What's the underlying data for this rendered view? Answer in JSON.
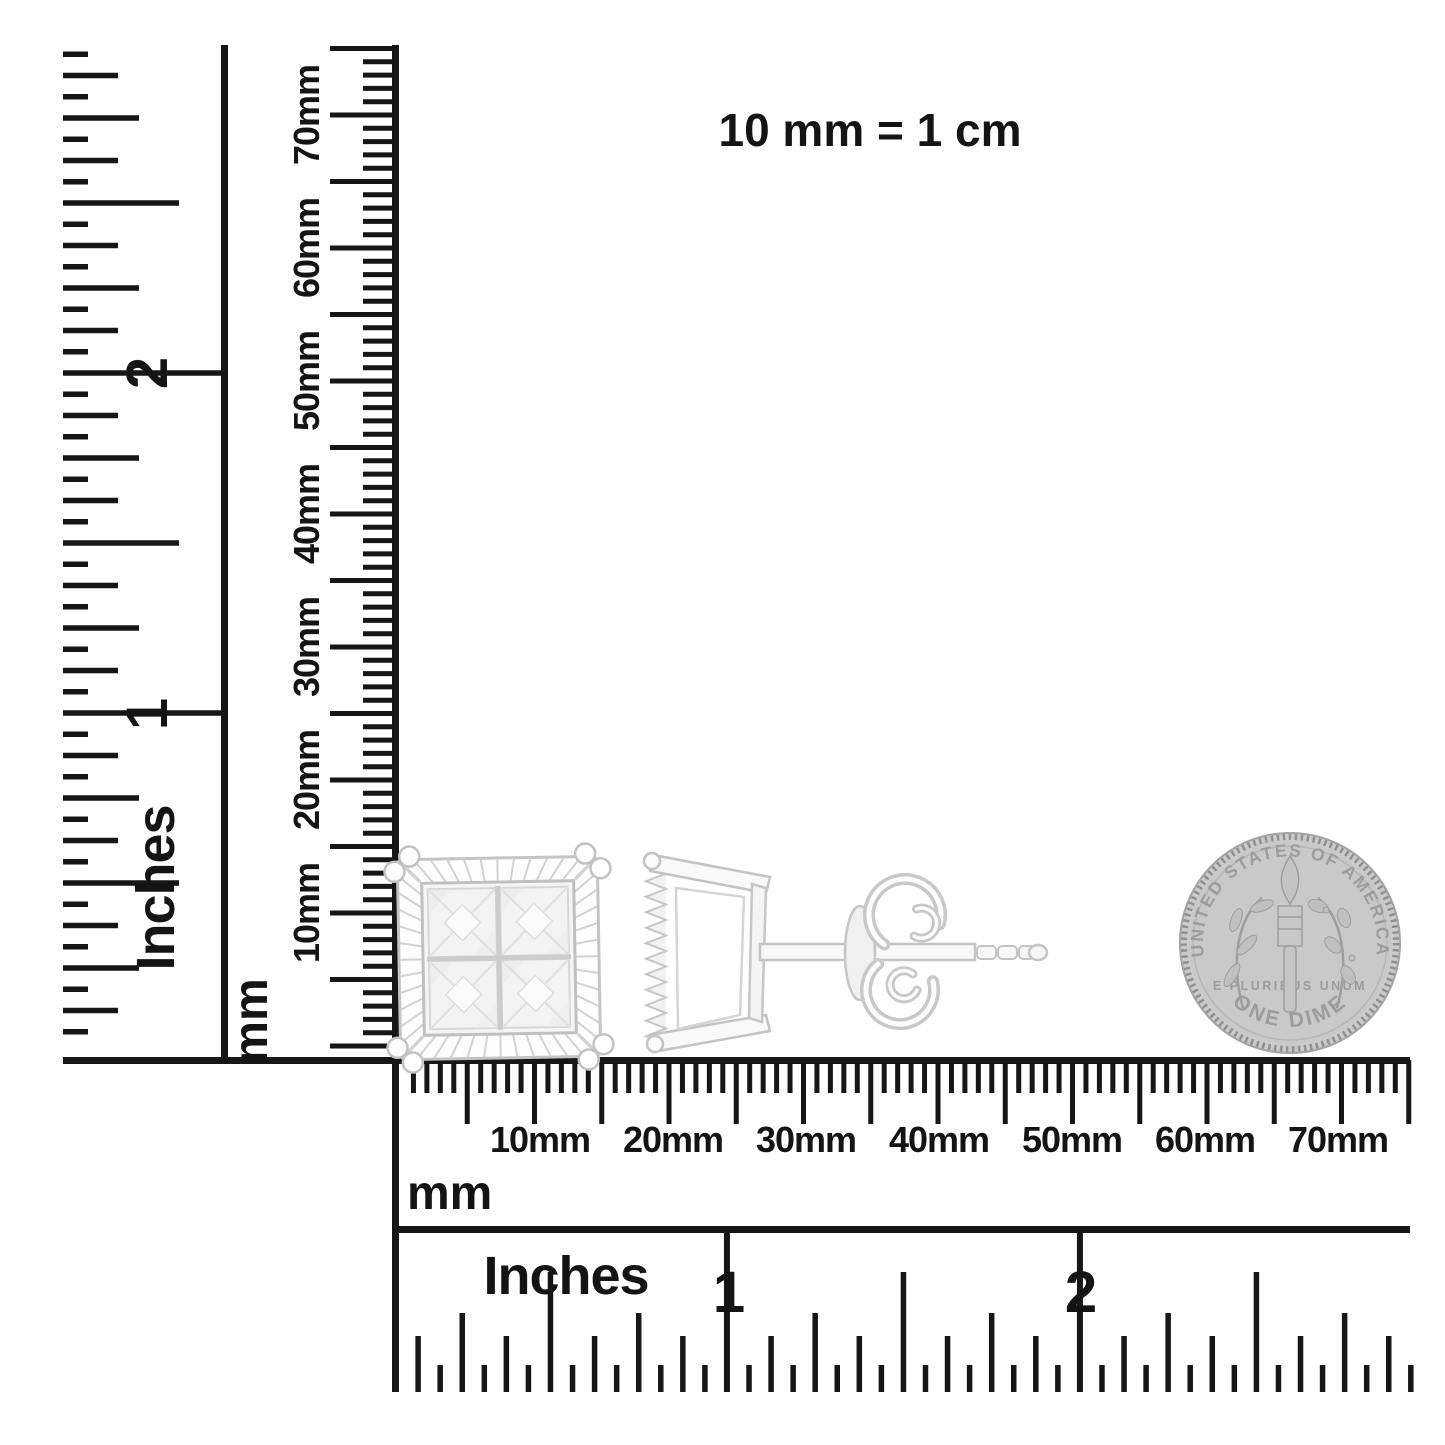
{
  "note": {
    "text": "10 mm = 1 cm"
  },
  "rulers": {
    "mm_unit": "mm",
    "inch_unit": "Inches",
    "mm_labels": [
      "10mm",
      "20mm",
      "30mm",
      "40mm",
      "50mm",
      "60mm",
      "70mm"
    ],
    "inch_labels": [
      "1",
      "2"
    ]
  },
  "coin": {
    "top_text": "UNITED STATES OF AMERICA",
    "motto": "E PLURIBUS UNUM",
    "bottom_text": "ONE DIME"
  },
  "colors": {
    "ink": "#161616",
    "metal_stroke": "#c4c4c4",
    "metal_light": "#f6f6f6",
    "coin_face": "#cbcbcb",
    "coin_detail": "#9c9c9c"
  }
}
